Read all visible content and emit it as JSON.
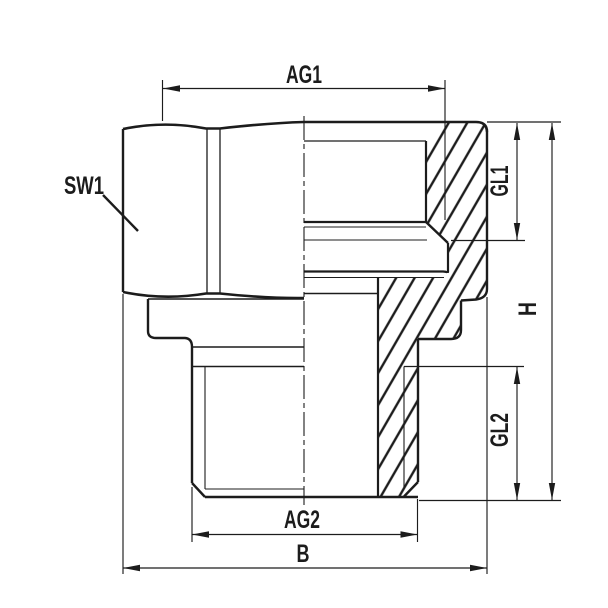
{
  "drawing": {
    "type": "technical-section-drawing",
    "subject": "threaded adapter fitting, half view / half section",
    "background": "#ffffff",
    "line_color": "#1c1c1c",
    "labels": {
      "ag1": "AG1",
      "sw1": "SW1",
      "gl1": "GL1",
      "h": "H",
      "gl2": "GL2",
      "ag2": "AG2",
      "b": "B"
    }
  }
}
